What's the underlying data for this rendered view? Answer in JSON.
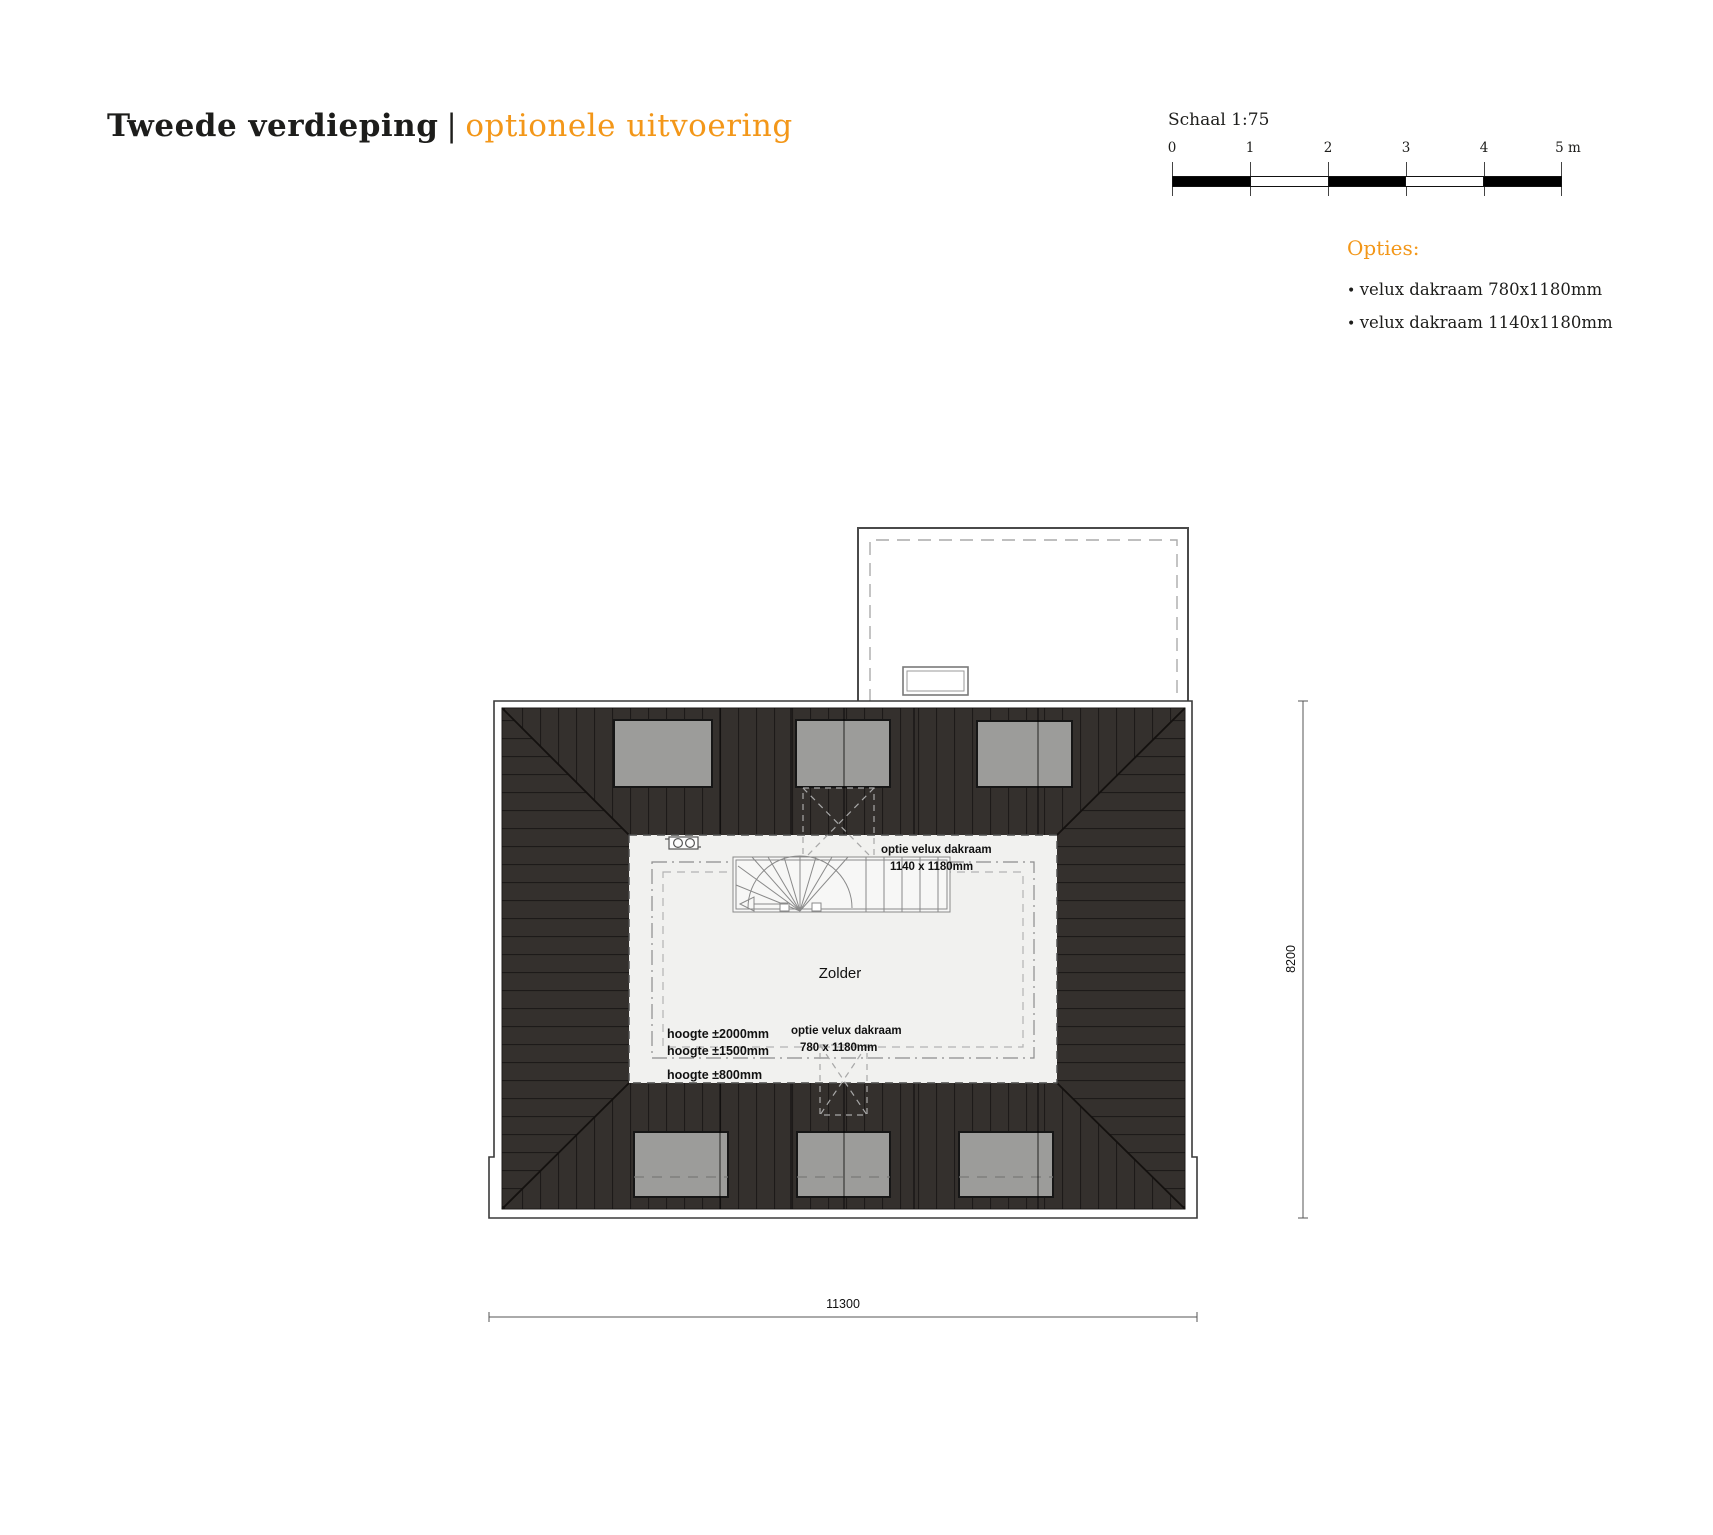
{
  "header": {
    "title": "Tweede verdieping",
    "separator": "|",
    "subtitle": "optionele uitvoering"
  },
  "scalebar": {
    "label": "Schaal 1:75",
    "ticks": [
      "0",
      "1",
      "2",
      "3",
      "4",
      "5 m"
    ]
  },
  "options": {
    "heading": "Opties:",
    "items": [
      "velux dakraam 780x1180mm",
      "velux dakraam 1140x1180mm"
    ]
  },
  "plan": {
    "room": "Zolder",
    "velux_top": {
      "line1": "optie velux dakraam",
      "line2": "1140 x 1180mm"
    },
    "velux_bottom": {
      "line1": "optie velux dakraam",
      "line2": "780 x 1180mm"
    },
    "heights": {
      "h2000": "hoogte ±2000mm",
      "h1500": "hoogte ±1500mm",
      "h800": "hoogte ±800mm"
    },
    "dim_width": "11300",
    "dim_height": "8200"
  },
  "colors": {
    "accent": "#f39719",
    "ink": "#1d1d1b",
    "roof_dark": "#34302d",
    "skylight_gray": "#9c9c9a",
    "interior": "#f1f1ef"
  }
}
